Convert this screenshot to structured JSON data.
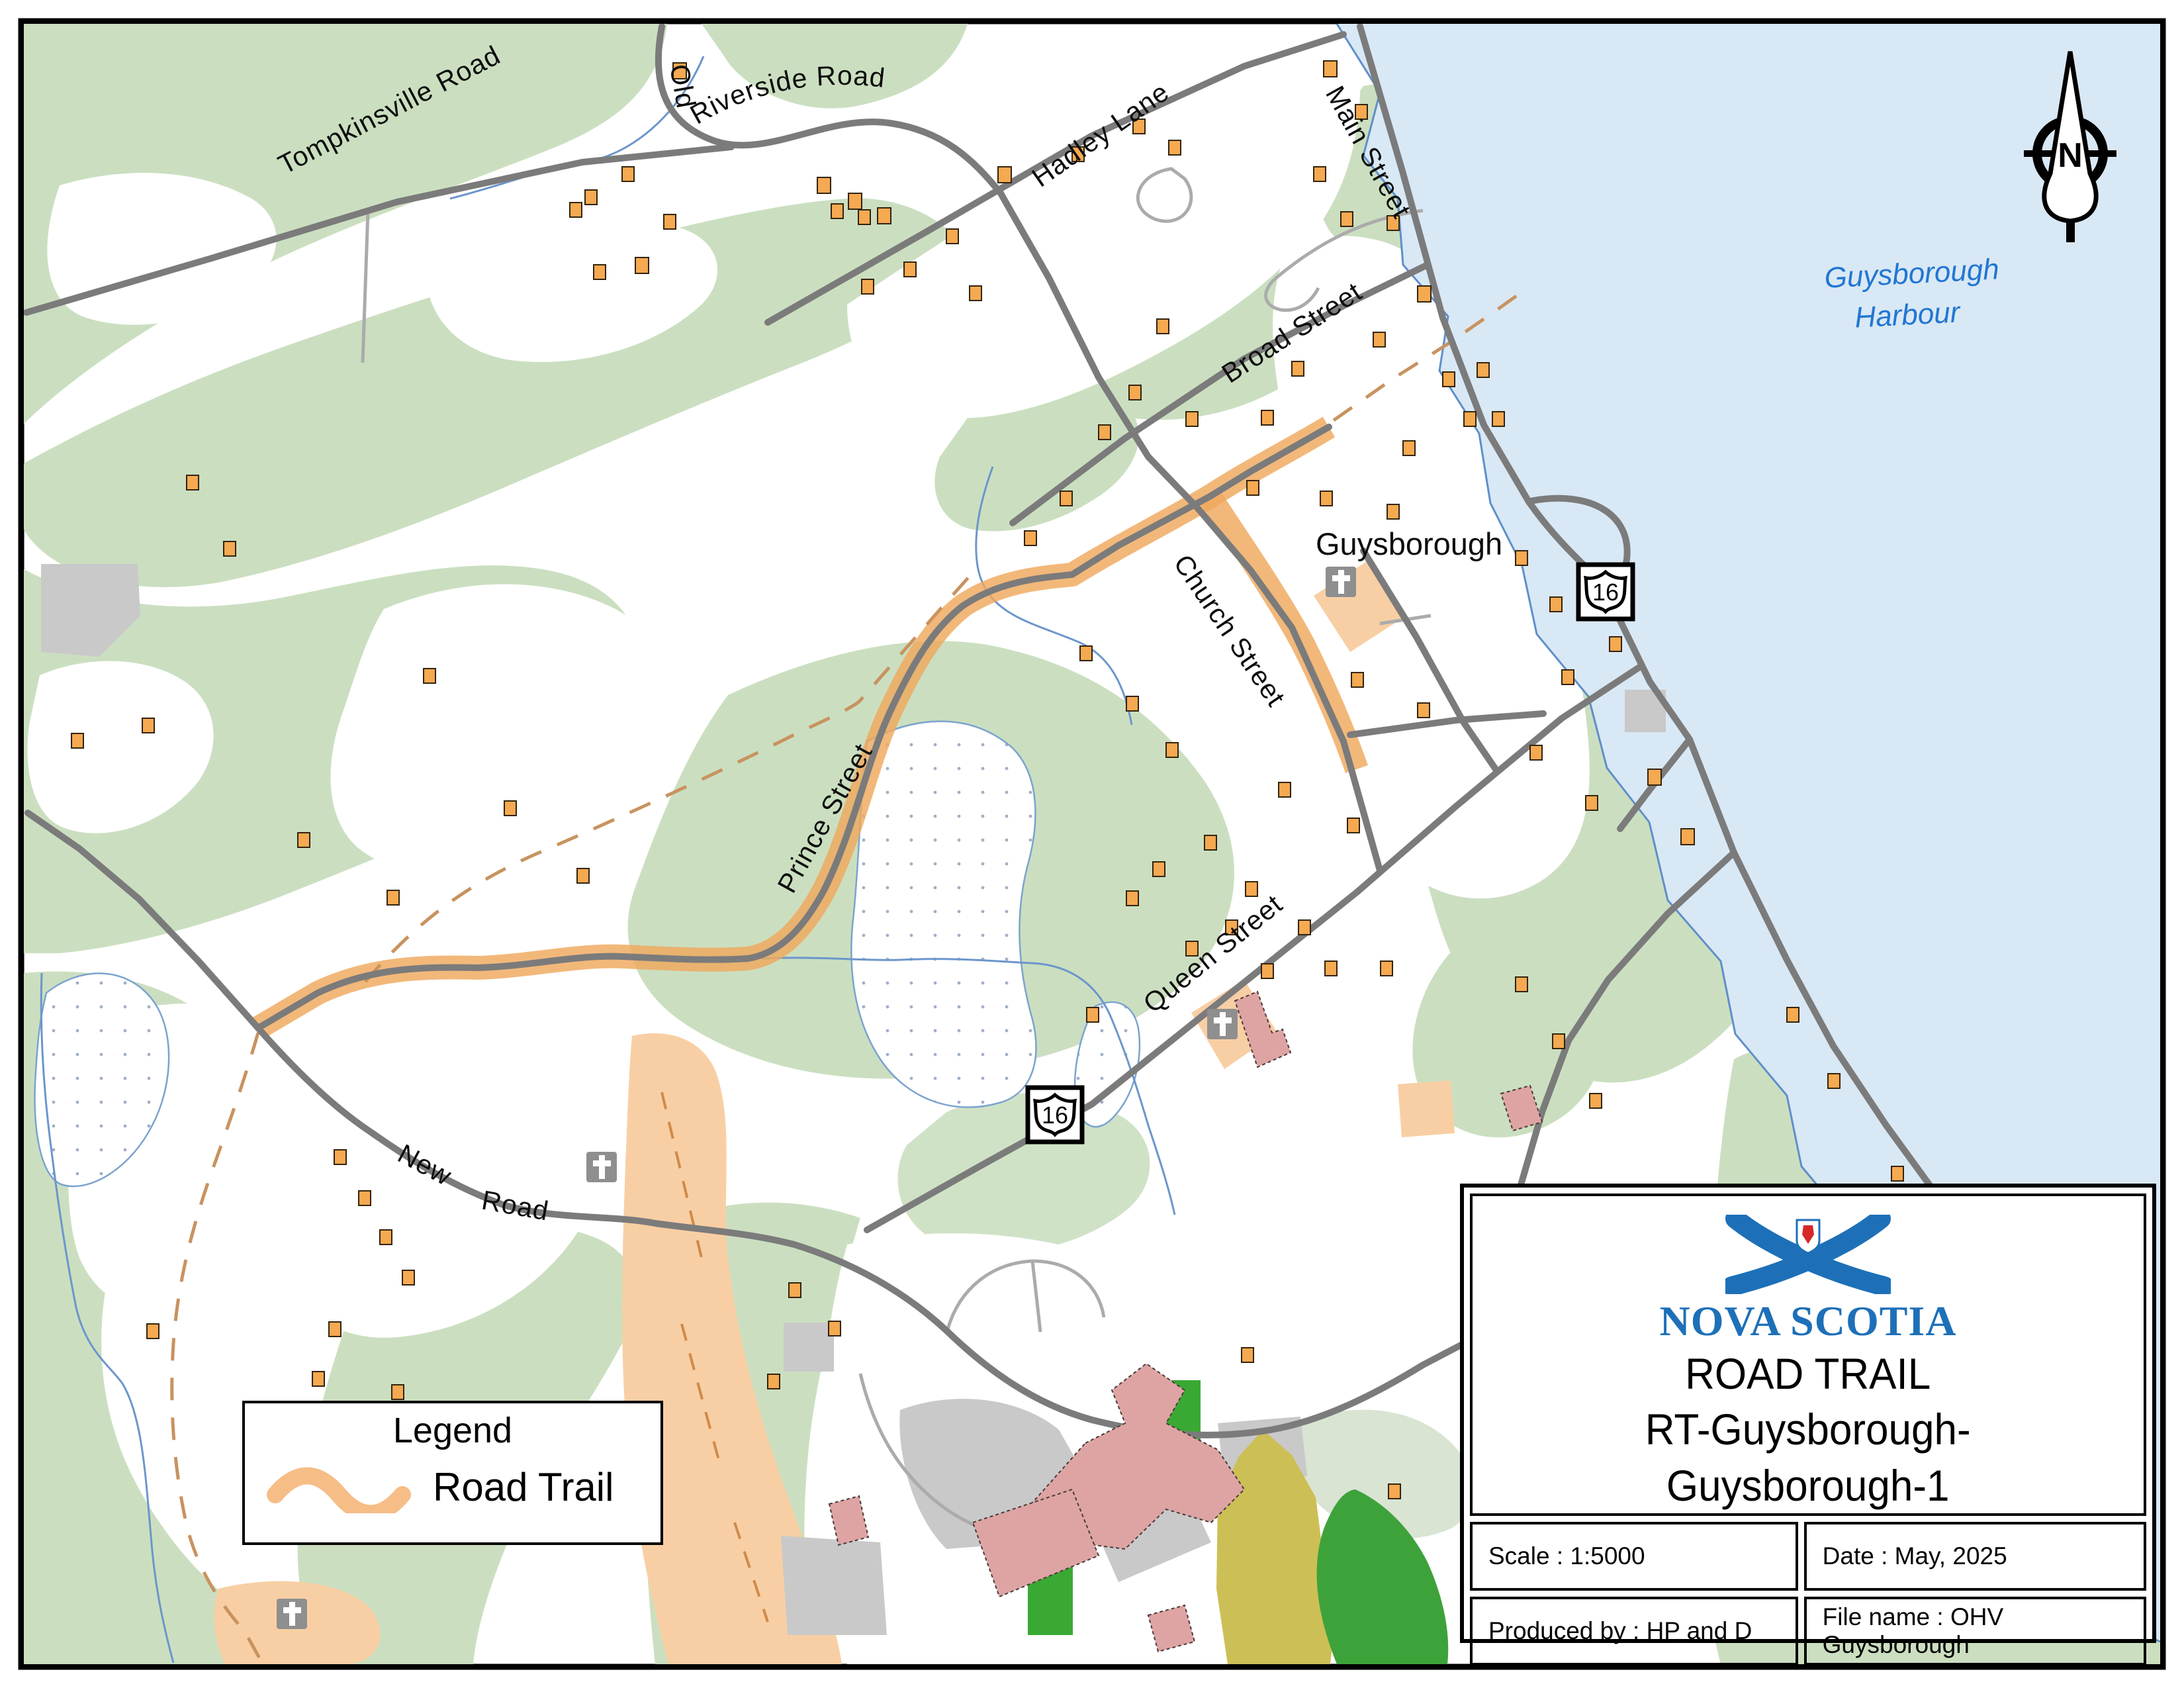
{
  "map": {
    "town": "Guysborough",
    "harbour": {
      "line1": "Guysborough",
      "line2": "Harbour"
    },
    "route_number": "16",
    "north": "N",
    "streets": {
      "old": "Old",
      "riverside": "Riverside Road",
      "tompkinsville": "Tompkinsville Road",
      "hadley": "Hadley Lane",
      "main": "Main Street",
      "broad": "Broad Street",
      "church": "Church Street",
      "prince": "Prince  Street",
      "queen": "Queen Street",
      "new_word": "New",
      "road_word": "Road"
    }
  },
  "legend": {
    "title": "Legend",
    "road_trail": "Road Trail"
  },
  "title_block": {
    "org": "NOVA SCOTIA",
    "line1": "ROAD TRAIL",
    "line2": "RT-Guysborough-",
    "line3": "Guysborough-1",
    "scale": "Scale : 1:5000",
    "date": "Date : May, 2025",
    "produced": "Produced by : HP and D",
    "file": "File name : OHV Guysborough"
  },
  "colors": {
    "water": "#d9e8f5",
    "coastline": "#5f8fc9",
    "vegetation": "#cbdfc0",
    "pale_vegetation": "#d9e4d3",
    "road": "#7b7b7b",
    "trail": "#efa85d",
    "building": "#f5a951",
    "cleared": "#f8cfa4",
    "logo_blue": "#1d70b8"
  }
}
